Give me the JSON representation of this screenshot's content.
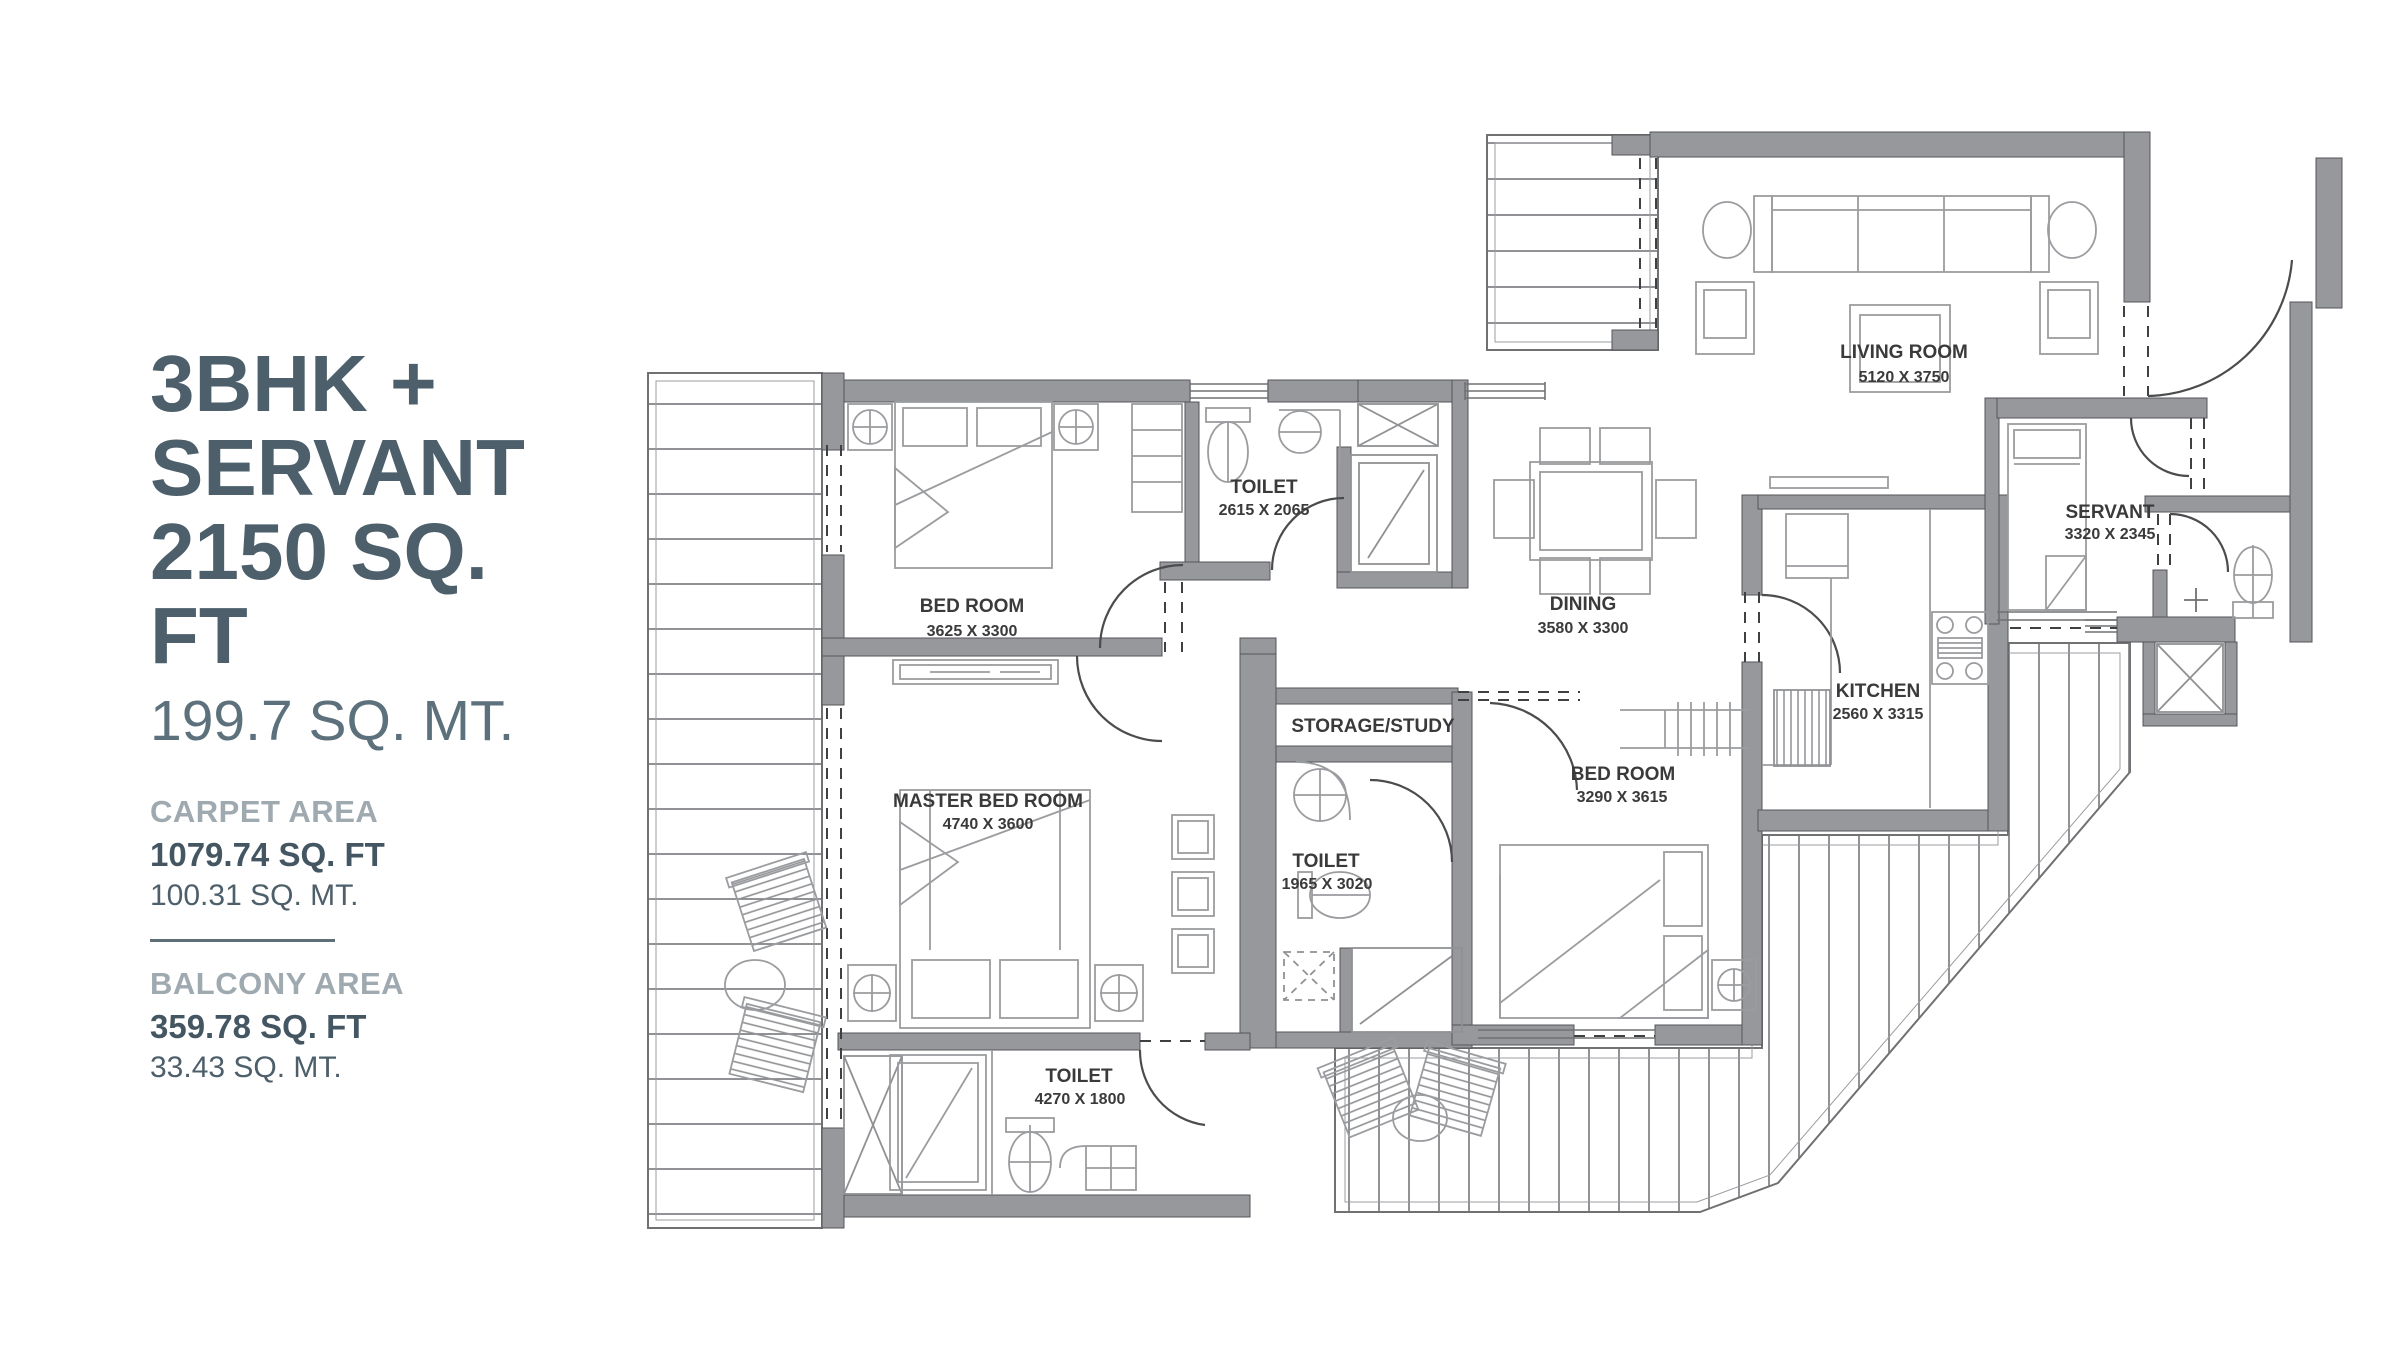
{
  "panel": {
    "title_line1": "3BHK +",
    "title_line2": "SERVANT",
    "title_line3": "2150 SQ. FT",
    "subtitle": "199.7 SQ. MT.",
    "carpet": {
      "heading": "CARPET AREA",
      "sqft": "1079.74 SQ. FT",
      "sqmt": "100.31 SQ. MT."
    },
    "balcony": {
      "heading": "BALCONY AREA",
      "sqft": "359.78 SQ. FT",
      "sqmt": "33.43 SQ. MT."
    }
  },
  "rooms": {
    "living": {
      "name": "LIVING ROOM",
      "dim": "5120 X 3750"
    },
    "toilet_top": {
      "name": "TOILET",
      "dim": "2615 X 2065"
    },
    "bedroom_top": {
      "name": "BED ROOM",
      "dim": "3625 X 3300"
    },
    "dining": {
      "name": "DINING",
      "dim": "3580 X 3300"
    },
    "servant": {
      "name": "SERVANT",
      "dim": "3320 X 2345"
    },
    "kitchen": {
      "name": "KITCHEN",
      "dim": "2560 X 3315"
    },
    "master": {
      "name": "MASTER BED ROOM",
      "dim": "4740 X 3600"
    },
    "storage": {
      "name": "STORAGE/STUDY"
    },
    "toilet_mid": {
      "name": "TOILET",
      "dim": "1965 X 3020"
    },
    "bedroom_right": {
      "name": "BED ROOM",
      "dim": "3290 X 3615"
    },
    "toilet_bottom": {
      "name": "TOILET",
      "dim": "4270 X 1800"
    }
  },
  "colors": {
    "wall": "#96989B",
    "furniture_line": "#9a9c9f",
    "label_text": "#3a3a3a",
    "title_slate": "#4c5f6b",
    "heading_gray": "#9fa9b0",
    "background": "#ffffff"
  }
}
